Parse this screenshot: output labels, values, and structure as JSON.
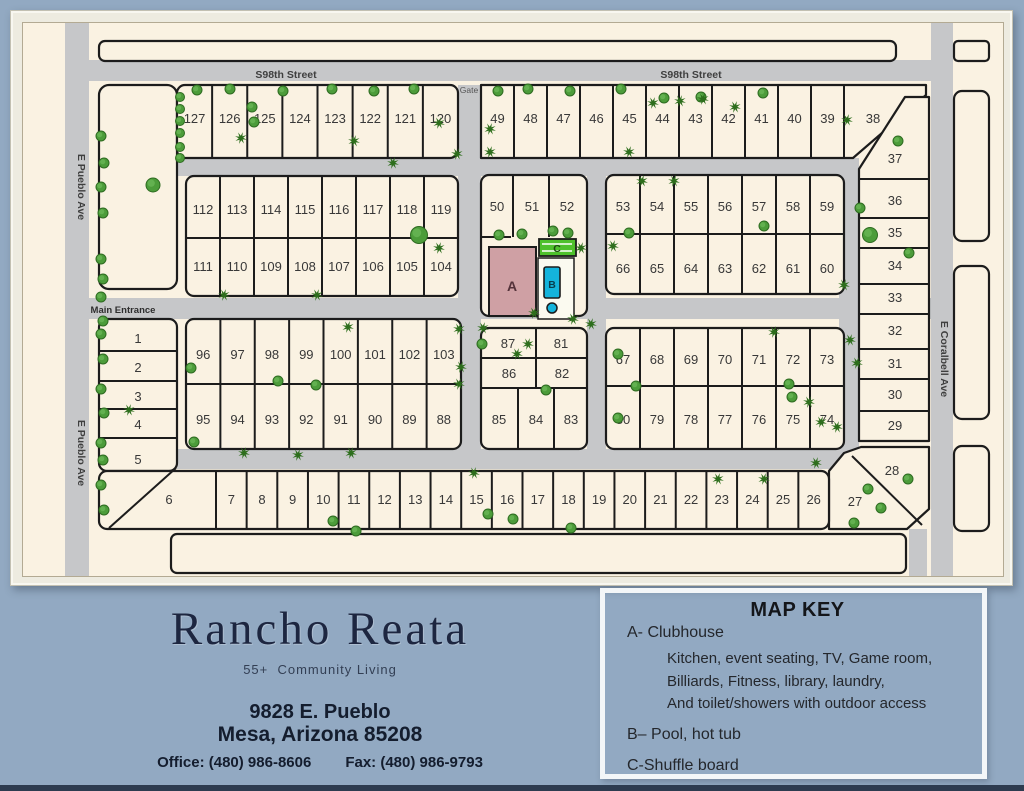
{
  "branding": {
    "title": "Rancho Reata",
    "subtitle": "55+  Community Living",
    "address_line1": "9828 E. Pueblo",
    "address_line2": "Mesa, Arizona 85208",
    "office": "Office: (480) 986-8606",
    "fax": "Fax: (480) 986-9793"
  },
  "map_key": {
    "title": "MAP KEY",
    "clubhouse": "A- Clubhouse",
    "clubhouse_details": [
      "Kitchen, event seating, TV, Game room,",
      "Billiards, Fitness, library, laundry,",
      "And toilet/showers with outdoor access"
    ],
    "pool": "B– Pool, hot tub",
    "shuffleboard": "C-Shuffle board"
  },
  "map": {
    "streets": {
      "s98th_west": "S98th Street",
      "s98th_east": "S98th Street",
      "pueblo_north": "E Pueblo Ave",
      "pueblo_south": "E Pueblo Ave",
      "coralbell": "E Coralbell Ave",
      "gate": "Gate",
      "main_entrance": "Main Entrance"
    },
    "buildings": {
      "clubhouse": "A",
      "pool": "B",
      "shuffleboard": "C"
    },
    "lots": {
      "top_left_row": [
        "127",
        "126",
        "125",
        "124",
        "123",
        "122",
        "121",
        "120"
      ],
      "upper_left_row1": [
        "112",
        "113",
        "114",
        "115",
        "116",
        "117",
        "118",
        "119"
      ],
      "upper_left_row2": [
        "111",
        "110",
        "109",
        "108",
        "107",
        "106",
        "105",
        "104"
      ],
      "top_right_row": [
        "49",
        "48",
        "47",
        "46",
        "45",
        "44",
        "43",
        "42",
        "41",
        "40",
        "39"
      ],
      "lot_38": "38",
      "clubhouse_block_row": [
        "50",
        "51",
        "52"
      ],
      "upper_center_row1": [
        "53",
        "54",
        "55",
        "56",
        "57",
        "58",
        "59"
      ],
      "upper_center_row2": [
        "66",
        "65",
        "64",
        "63",
        "62",
        "61",
        "60"
      ],
      "east_column": [
        "37",
        "36",
        "35",
        "34",
        "33",
        "32",
        "31",
        "30",
        "29"
      ],
      "southeast_corner": [
        "28",
        "27"
      ],
      "west_column": [
        "1",
        "2",
        "3",
        "4",
        "5"
      ],
      "mid_west_row1": [
        "96",
        "97",
        "98",
        "99",
        "100",
        "101",
        "102",
        "103"
      ],
      "mid_west_row2": [
        "95",
        "94",
        "93",
        "92",
        "91",
        "90",
        "89",
        "88"
      ],
      "club_south_row1": [
        "87",
        "81"
      ],
      "club_south_row2": [
        "86",
        "82"
      ],
      "club_south_row3": [
        "85",
        "84",
        "83"
      ],
      "mid_east_row1": [
        "67",
        "68",
        "69",
        "70",
        "71",
        "72",
        "73"
      ],
      "mid_east_row2": [
        "80",
        "79",
        "78",
        "77",
        "76",
        "75",
        "74"
      ],
      "south_row": [
        "6",
        "7",
        "8",
        "9",
        "10",
        "11",
        "12",
        "13",
        "14",
        "15",
        "16",
        "17",
        "18",
        "19",
        "20",
        "21",
        "22",
        "23",
        "24",
        "25",
        "26"
      ]
    }
  },
  "colors": {
    "page_background": "#92a9c2",
    "road": "#c6c7c9",
    "ground": "#faf2e2",
    "clubhouse_fill": "#cfa0a4",
    "pool_fill": "#14b4dc",
    "shuffleboard_fill": "#4ec12c",
    "tree_green": "#4c9c3a"
  }
}
